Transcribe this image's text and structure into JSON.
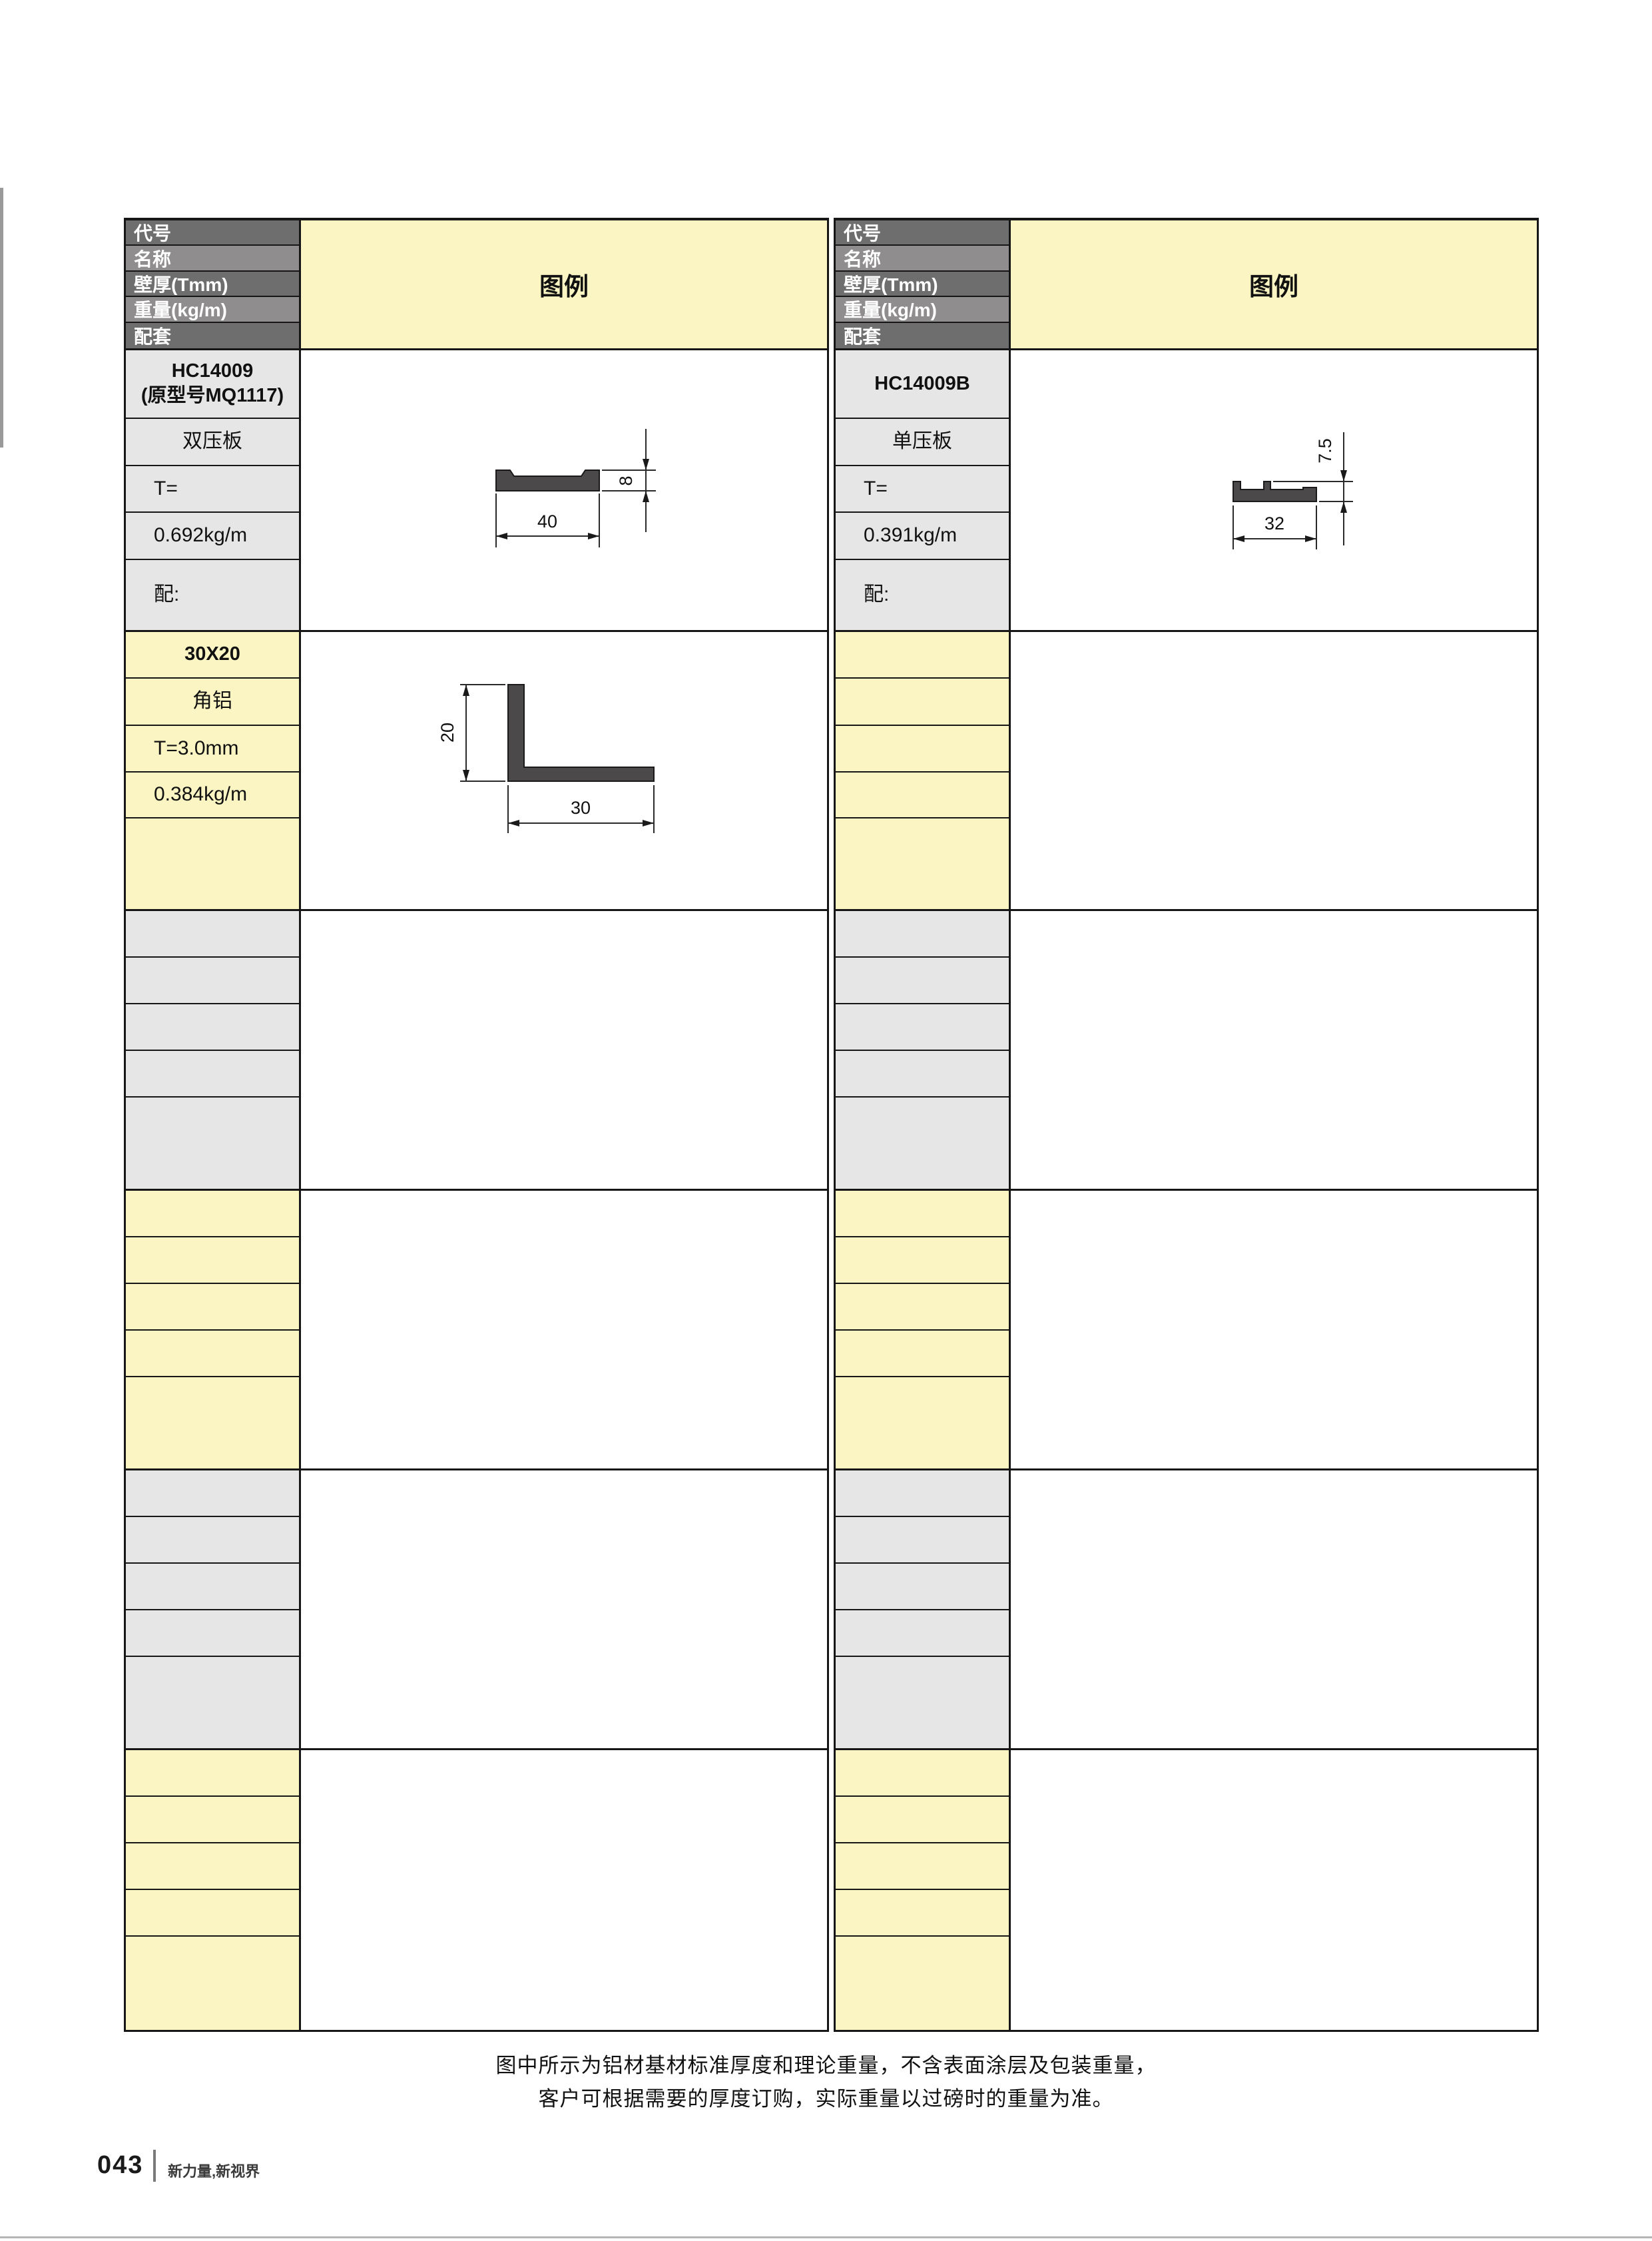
{
  "header_labels": [
    "代号",
    "名称",
    "壁厚(Tmm)",
    "重量(kg/m)",
    "配套"
  ],
  "legend_title": "图例",
  "left_table": {
    "group1": {
      "code_line1": "HC14009",
      "code_line2": "(原型号MQ1117)",
      "name": "双压板",
      "thickness": "T=",
      "weight": "0.692kg/m",
      "match": "配:",
      "dim_width": "40",
      "dim_height": "8"
    },
    "group2": {
      "code": "30X20",
      "name": "角铝",
      "thickness": "T=3.0mm",
      "weight": "0.384kg/m",
      "dim_width": "30",
      "dim_height": "20"
    }
  },
  "right_table": {
    "group1": {
      "code": "HC14009B",
      "name": "单压板",
      "thickness": "T=",
      "weight": "0.391kg/m",
      "match": "配:",
      "dim_width": "32",
      "dim_height": "7.5"
    }
  },
  "footer": {
    "note_line1": "图中所示为铝材基材标准厚度和理论重量，不含表面涂层及包装重量，",
    "note_line2": "客户可根据需要的厚度订购，实际重量以过磅时的重量为准。",
    "page_number": "043",
    "tagline": "新力量,新视界"
  },
  "colors": {
    "header_dark": "#6f6e6f",
    "header_light": "#8f8d8e",
    "gray_cell": "#e7e6e6",
    "yellow_cell": "#faf5c2",
    "profile_fill": "#4b494a"
  }
}
